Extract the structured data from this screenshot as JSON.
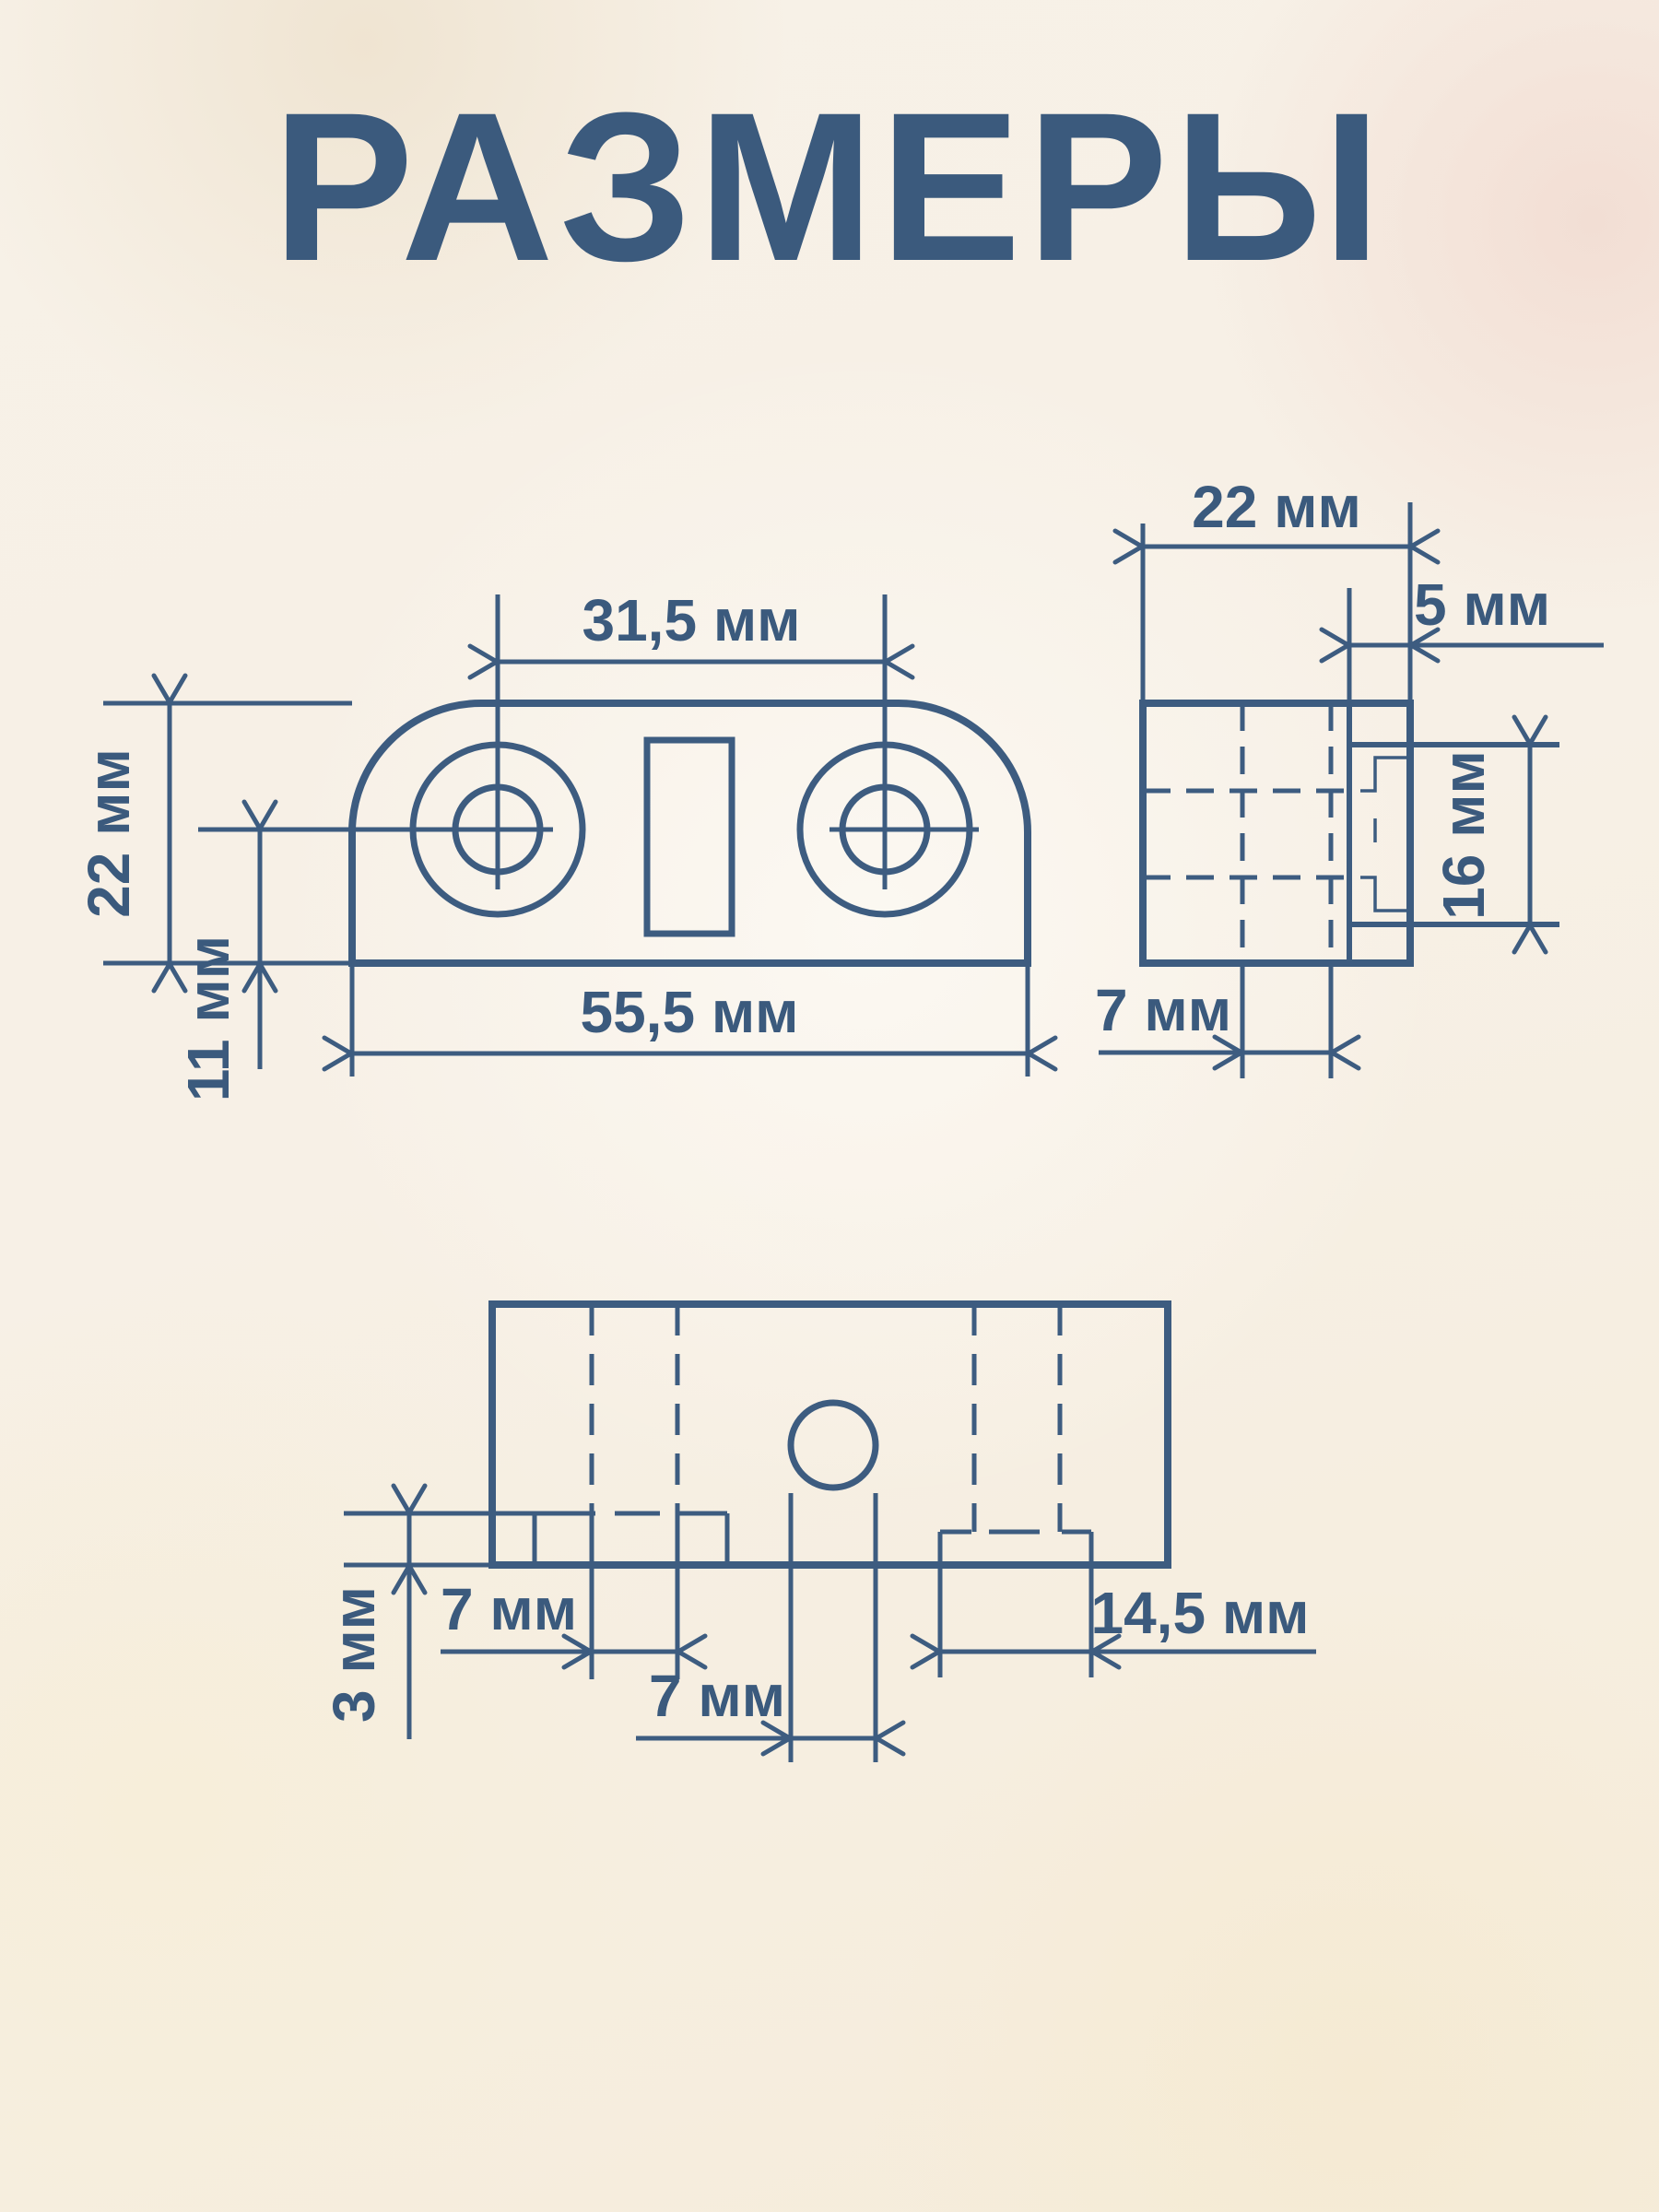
{
  "title": "РАЗМЕРЫ",
  "unit": "мм",
  "colors": {
    "ink": "#3b5a7d",
    "line": "#3d5c80",
    "background": "#f5eee2"
  },
  "dims": {
    "front": {
      "hole_spacing": "31,5 мм",
      "height": "22 мм",
      "hole_offset": "11 мм",
      "width": "55,5 мм"
    },
    "side": {
      "depth": "22 мм",
      "groove_offset": "5 мм",
      "groove_height": "16 мм",
      "web": "7 мм"
    },
    "bottom": {
      "step_depth": "3 мм",
      "left_slot": "7 мм",
      "hole_diameter": "7 мм",
      "notch_width": "14,5 мм"
    }
  }
}
